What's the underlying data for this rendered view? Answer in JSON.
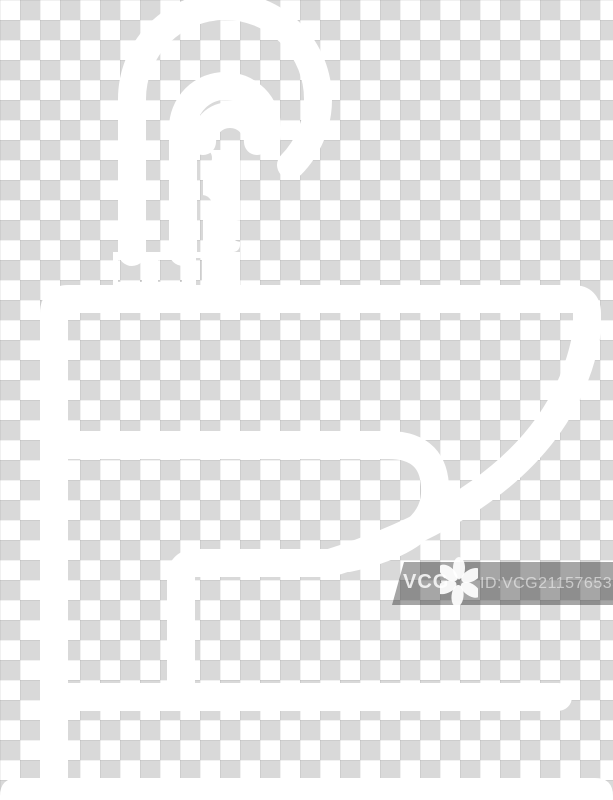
{
  "background": {
    "description": "transparency-checkerboard",
    "checker_gray": "#d9d9d9",
    "checker_white": "#ffffff",
    "cell_size_px": 20
  },
  "icon": {
    "name": "pedestal-washbasin-sink-line-icon",
    "color": "#ffffff"
  },
  "watermark": {
    "brand": "VCG",
    "id_label": "ID:VCG211576535951",
    "bar_color": "rgba(20,20,20,0.38)",
    "text_color": "rgba(255,255,255,0.52)",
    "flower_icon": "vcg-flower-icon"
  }
}
